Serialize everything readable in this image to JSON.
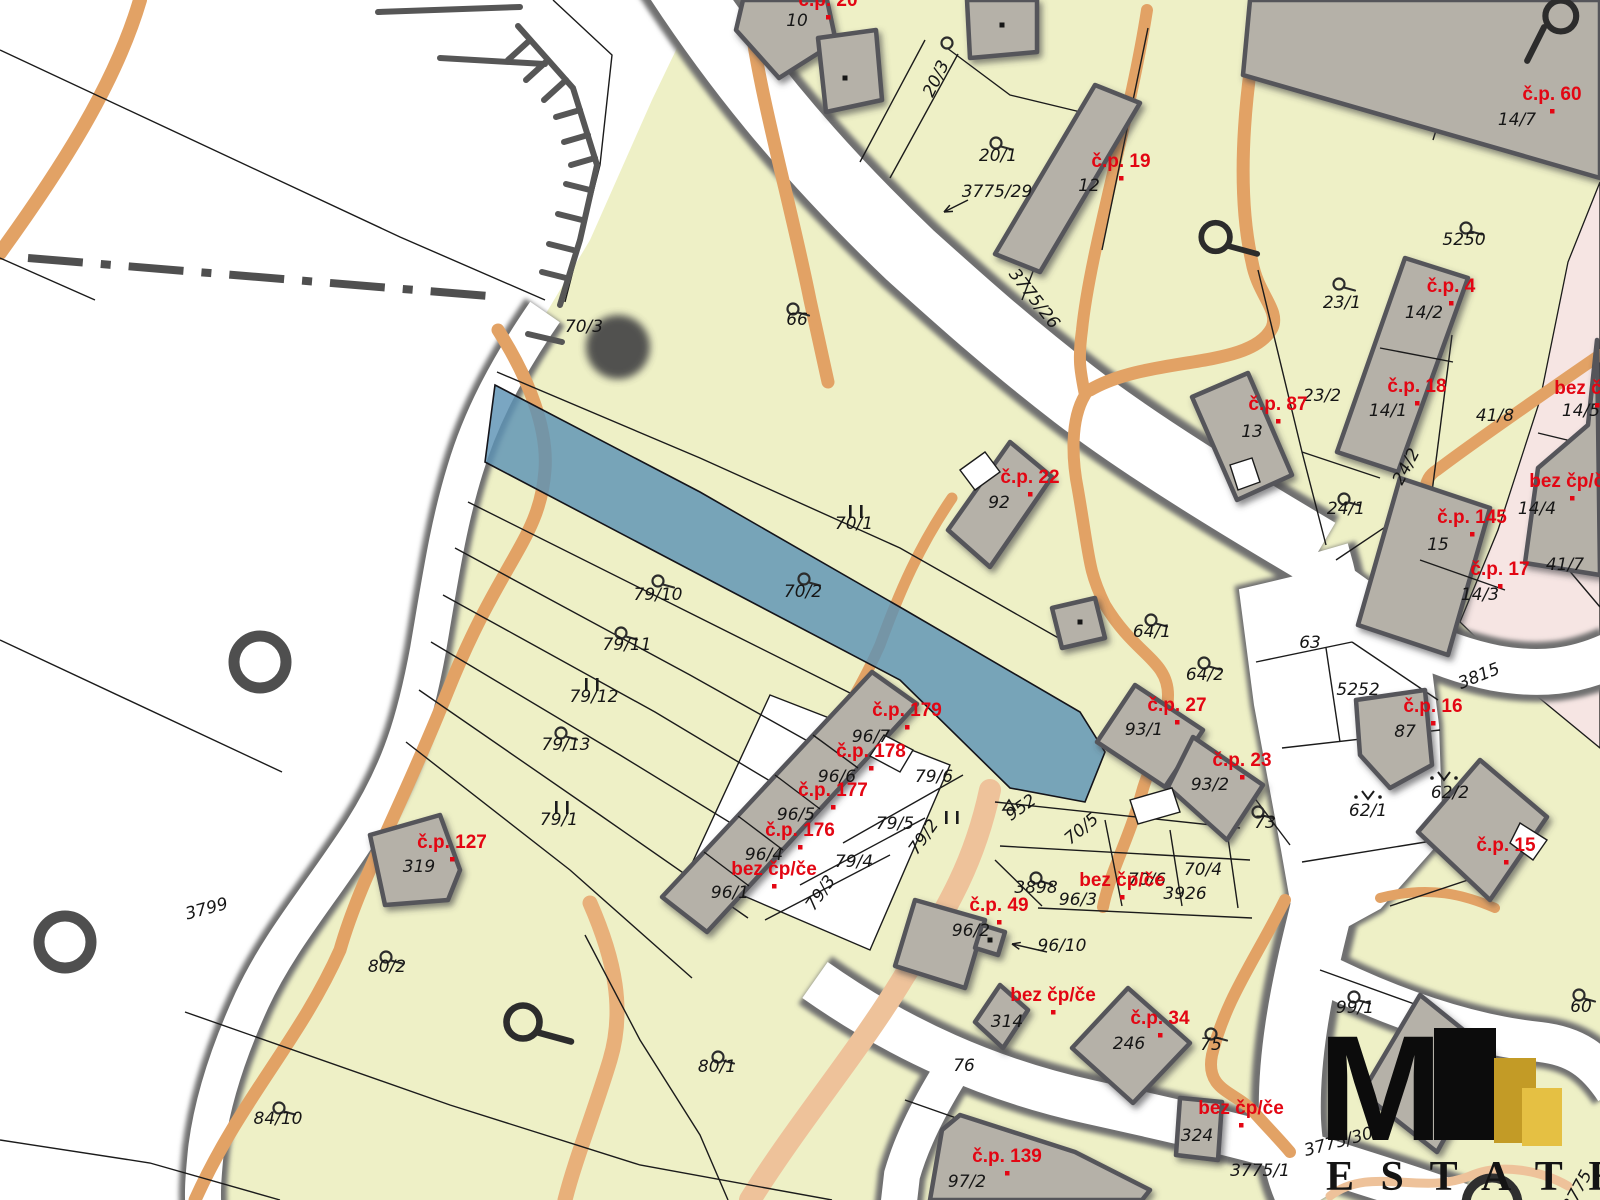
{
  "map": {
    "colors": {
      "background": "#ffffff",
      "parcel_fill": "#eef0c6",
      "building_fill": "#b5b1a8",
      "building_stroke": "#54545a",
      "road_fill": "#ffffff",
      "road_casing": "#6f6f6f",
      "line": "#1b1b1b",
      "highlight_parcel": "#5d92b4",
      "path_orange": "#e2a265",
      "path_orange_light": "#eec29a",
      "pink_area": "#f6e5e3",
      "label_black": "#161616",
      "label_red": "#e30613",
      "logo_black": "#0c0c0c",
      "logo_gold_dark": "#c39b26",
      "logo_gold_light": "#e5c043"
    },
    "parcel_labels": [
      {
        "text": "10",
        "x": 797,
        "y": 26
      },
      {
        "text": "20/1",
        "x": 998,
        "y": 161
      },
      {
        "text": "20/3",
        "x": 941,
        "y": 81,
        "rot": -64
      },
      {
        "text": "3775/29",
        "x": 997,
        "y": 197
      },
      {
        "text": "12",
        "x": 1089,
        "y": 191
      },
      {
        "text": "14/7",
        "x": 1517,
        "y": 125
      },
      {
        "text": "5250",
        "x": 1464,
        "y": 245
      },
      {
        "text": "23/1",
        "x": 1342,
        "y": 308
      },
      {
        "text": "14/2",
        "x": 1424,
        "y": 318
      },
      {
        "text": "3775/26",
        "x": 1030,
        "y": 302,
        "rot": 52
      },
      {
        "text": "66",
        "x": 797,
        "y": 325
      },
      {
        "text": "70/3",
        "x": 584,
        "y": 332
      },
      {
        "text": "23/2",
        "x": 1322,
        "y": 401
      },
      {
        "text": "14/1",
        "x": 1388,
        "y": 416
      },
      {
        "text": "13",
        "x": 1252,
        "y": 437
      },
      {
        "text": "41/8",
        "x": 1495,
        "y": 421
      },
      {
        "text": "14/5",
        "x": 1581,
        "y": 416
      },
      {
        "text": "24/2",
        "x": 1411,
        "y": 469,
        "rot": -62
      },
      {
        "text": "92",
        "x": 999,
        "y": 508
      },
      {
        "text": "24/1",
        "x": 1346,
        "y": 514
      },
      {
        "text": "70/1",
        "x": 854,
        "y": 529
      },
      {
        "text": "14/4",
        "x": 1537,
        "y": 514
      },
      {
        "text": "15",
        "x": 1438,
        "y": 550
      },
      {
        "text": "41/7",
        "x": 1565,
        "y": 570
      },
      {
        "text": "14/3",
        "x": 1480,
        "y": 600
      },
      {
        "text": "79/10",
        "x": 658,
        "y": 600
      },
      {
        "text": "70/2",
        "x": 803,
        "y": 597
      },
      {
        "text": "64/1",
        "x": 1152,
        "y": 637
      },
      {
        "text": "63",
        "x": 1310,
        "y": 648
      },
      {
        "text": "79/11",
        "x": 627,
        "y": 650
      },
      {
        "text": "3815",
        "x": 1481,
        "y": 681,
        "rot": -22
      },
      {
        "text": "64/2",
        "x": 1205,
        "y": 680
      },
      {
        "text": "5252",
        "x": 1358,
        "y": 695
      },
      {
        "text": "79/12",
        "x": 594,
        "y": 702
      },
      {
        "text": "87",
        "x": 1405,
        "y": 737
      },
      {
        "text": "93/1",
        "x": 1144,
        "y": 735
      },
      {
        "text": "96/7",
        "x": 871,
        "y": 742
      },
      {
        "text": "79/13",
        "x": 566,
        "y": 750
      },
      {
        "text": "62/2",
        "x": 1450,
        "y": 798
      },
      {
        "text": "79/6",
        "x": 934,
        "y": 782
      },
      {
        "text": "96/6",
        "x": 837,
        "y": 782
      },
      {
        "text": "93/2",
        "x": 1210,
        "y": 790
      },
      {
        "text": "62/1",
        "x": 1368,
        "y": 816
      },
      {
        "text": "96/5",
        "x": 796,
        "y": 820
      },
      {
        "text": "79/1",
        "x": 559,
        "y": 825
      },
      {
        "text": "73",
        "x": 1265,
        "y": 828
      },
      {
        "text": "79/5",
        "x": 895,
        "y": 829
      },
      {
        "text": "70/5",
        "x": 1085,
        "y": 833,
        "rot": -40
      },
      {
        "text": "79/2",
        "x": 928,
        "y": 840,
        "rot": -55
      },
      {
        "text": "952",
        "x": 1024,
        "y": 812,
        "rot": -35
      },
      {
        "text": "96/4",
        "x": 764,
        "y": 860
      },
      {
        "text": "79/4",
        "x": 854,
        "y": 867
      },
      {
        "text": "70/4",
        "x": 1203,
        "y": 875
      },
      {
        "text": "319",
        "x": 419,
        "y": 872
      },
      {
        "text": "70/6",
        "x": 1147,
        "y": 885
      },
      {
        "text": "3898",
        "x": 1036,
        "y": 893
      },
      {
        "text": "79/3",
        "x": 825,
        "y": 896,
        "rot": -55
      },
      {
        "text": "96/1",
        "x": 730,
        "y": 898
      },
      {
        "text": "3926",
        "x": 1185,
        "y": 899
      },
      {
        "text": "96/3",
        "x": 1078,
        "y": 905
      },
      {
        "text": "3799",
        "x": 208,
        "y": 914,
        "rot": -15
      },
      {
        "text": "96/2",
        "x": 971,
        "y": 936
      },
      {
        "text": "96/10",
        "x": 1062,
        "y": 951
      },
      {
        "text": "80/2",
        "x": 387,
        "y": 972
      },
      {
        "text": "314",
        "x": 1007,
        "y": 1027
      },
      {
        "text": "246",
        "x": 1129,
        "y": 1049
      },
      {
        "text": "75",
        "x": 1211,
        "y": 1050
      },
      {
        "text": "80/1",
        "x": 717,
        "y": 1072
      },
      {
        "text": "76",
        "x": 964,
        "y": 1071
      },
      {
        "text": "99/1",
        "x": 1355,
        "y": 1013
      },
      {
        "text": "60",
        "x": 1581,
        "y": 1012
      },
      {
        "text": "84/10",
        "x": 278,
        "y": 1124
      },
      {
        "text": "324",
        "x": 1197,
        "y": 1141
      },
      {
        "text": "3775/30",
        "x": 1340,
        "y": 1147,
        "rot": -15
      },
      {
        "text": "3775/1",
        "x": 1260,
        "y": 1176
      },
      {
        "text": "97/2",
        "x": 967,
        "y": 1187
      },
      {
        "text": "3775",
        "x": 1582,
        "y": 1193,
        "rot": -62
      }
    ],
    "building_labels": [
      {
        "text": "č.p. 20",
        "x": 828,
        "y": 6
      },
      {
        "text": "č.p. 19",
        "x": 1121,
        "y": 167
      },
      {
        "text": "č.p. 60",
        "x": 1552,
        "y": 100
      },
      {
        "text": "č.p. 4",
        "x": 1451,
        "y": 292
      },
      {
        "text": "č.p. 18",
        "x": 1417,
        "y": 392
      },
      {
        "text": "č.p. 87",
        "x": 1278,
        "y": 410
      },
      {
        "text": "č.p. 22",
        "x": 1030,
        "y": 483
      },
      {
        "text": "bez čp/če",
        "x": 1597,
        "y": 394
      },
      {
        "text": "č.p. 145",
        "x": 1472,
        "y": 523
      },
      {
        "text": "bez čp/če",
        "x": 1572,
        "y": 487
      },
      {
        "text": "č.p. 17",
        "x": 1500,
        "y": 575
      },
      {
        "text": "č.p. 16",
        "x": 1433,
        "y": 712
      },
      {
        "text": "č.p. 27",
        "x": 1177,
        "y": 711
      },
      {
        "text": "č.p. 23",
        "x": 1242,
        "y": 766
      },
      {
        "text": "č.p. 15",
        "x": 1506,
        "y": 851
      },
      {
        "text": "č.p. 179",
        "x": 907,
        "y": 716
      },
      {
        "text": "č.p. 178",
        "x": 871,
        "y": 757
      },
      {
        "text": "č.p. 177",
        "x": 833,
        "y": 796
      },
      {
        "text": "č.p. 176",
        "x": 800,
        "y": 836
      },
      {
        "text": "bez čp/če",
        "x": 774,
        "y": 875
      },
      {
        "text": "č.p. 127",
        "x": 452,
        "y": 848
      },
      {
        "text": "č.p. 49",
        "x": 999,
        "y": 911
      },
      {
        "text": "bez čp/če",
        "x": 1122,
        "y": 886
      },
      {
        "text": "bez čp/če",
        "x": 1053,
        "y": 1001
      },
      {
        "text": "č.p. 34",
        "x": 1160,
        "y": 1024
      },
      {
        "text": "bez čp/če",
        "x": 1241,
        "y": 1114
      },
      {
        "text": "č.p. 139",
        "x": 1007,
        "y": 1162
      }
    ],
    "symbols": [
      {
        "t": "lu",
        "x": 1000,
        "y": 143
      },
      {
        "t": "lu",
        "x": 1470,
        "y": 228
      },
      {
        "t": "lu",
        "x": 1343,
        "y": 284
      },
      {
        "t": "lu",
        "x": 797,
        "y": 309
      },
      {
        "t": "lu",
        "x": 1348,
        "y": 499
      },
      {
        "t": "lu",
        "x": 662,
        "y": 581
      },
      {
        "t": "lu",
        "x": 808,
        "y": 579
      },
      {
        "t": "lu",
        "x": 1155,
        "y": 620
      },
      {
        "t": "lu",
        "x": 625,
        "y": 633
      },
      {
        "t": "lu",
        "x": 1208,
        "y": 663
      },
      {
        "t": "lu",
        "x": 565,
        "y": 733
      },
      {
        "t": "lu",
        "x": 1262,
        "y": 812
      },
      {
        "t": "lu",
        "x": 1040,
        "y": 878
      },
      {
        "t": "lu",
        "x": 390,
        "y": 957
      },
      {
        "t": "lu",
        "x": 1358,
        "y": 997
      },
      {
        "t": "lu",
        "x": 1583,
        "y": 995
      },
      {
        "t": "lu",
        "x": 722,
        "y": 1057
      },
      {
        "t": "lu",
        "x": 1215,
        "y": 1034
      },
      {
        "t": "lu",
        "x": 283,
        "y": 1108
      },
      {
        "t": "lu",
        "x": 1226,
        "y": 237,
        "k": 2.6
      },
      {
        "t": "lu",
        "x": 535,
        "y": 1022,
        "k": 3.0
      },
      {
        "t": "lu",
        "x": 1572,
        "y": 16,
        "k": 2.8,
        "down": true
      },
      {
        "t": "ringthick",
        "x": 1492,
        "y": 1204
      },
      {
        "t": "ring",
        "x": 260,
        "y": 662
      },
      {
        "t": "ring",
        "x": 65,
        "y": 942
      },
      {
        "t": "ringsm",
        "x": 947,
        "y": 43
      },
      {
        "t": "tree",
        "x": 618,
        "y": 347
      },
      {
        "t": "ii",
        "x": 856,
        "y": 512
      },
      {
        "t": "ii",
        "x": 592,
        "y": 685
      },
      {
        "t": "ii",
        "x": 562,
        "y": 808
      },
      {
        "t": "ii",
        "x": 952,
        "y": 818
      },
      {
        "t": "vd",
        "x": 1368,
        "y": 799
      },
      {
        "t": "vd",
        "x": 1444,
        "y": 780
      },
      {
        "t": "tri",
        "x": 1009,
        "y": 806
      },
      {
        "t": "arr",
        "x1": 968,
        "y1": 200,
        "x2": 944,
        "y2": 212
      },
      {
        "t": "arr",
        "x1": 1047,
        "y1": 952,
        "x2": 1012,
        "y2": 944
      },
      {
        "t": "dot",
        "x": 1002,
        "y": 25
      },
      {
        "t": "dot",
        "x": 845,
        "y": 78
      },
      {
        "t": "dot",
        "x": 1080,
        "y": 622
      },
      {
        "t": "dot",
        "x": 990,
        "y": 940
      }
    ],
    "logo": {
      "title": "MI",
      "subtitle": "E S T A T E"
    }
  }
}
